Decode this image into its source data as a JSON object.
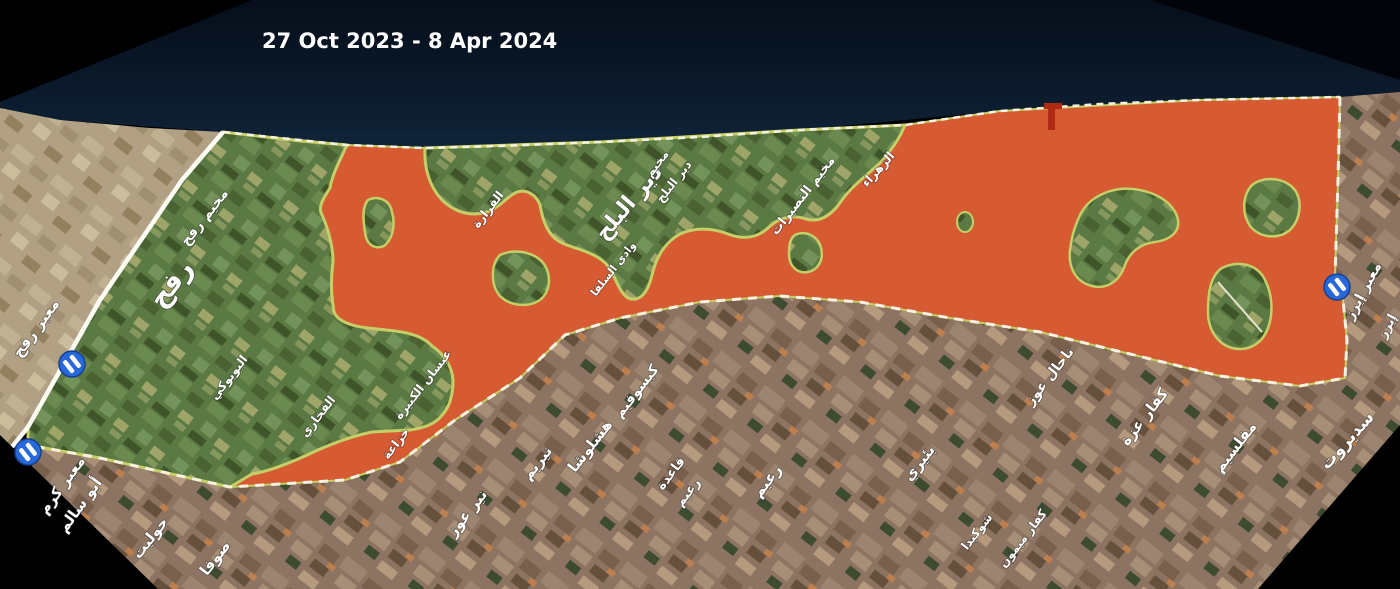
{
  "title": {
    "text": "27 Oct 2023 - 8 Apr 2024"
  },
  "map": {
    "colors": {
      "sea_dark": "#060e1a",
      "sea_light": "#102439",
      "overlay_orange": "#d65a32",
      "overlay_fringe": "#c6ce67",
      "gaza_green": "#5b7943",
      "israel_brown": "#8d7462",
      "egypt_tan": "#b1a083",
      "border_dash": "#f6f2de",
      "crossing_blue": "#2968d8",
      "label_white": "#ffffff",
      "pier_red": "#b02a14"
    },
    "labels": [
      {
        "id": "rafah-crossing",
        "text": "معبر رفح"
      },
      {
        "id": "kerem-shalom-1",
        "text": "معبر كرم"
      },
      {
        "id": "kerem-shalom-2",
        "text": "أبو سالم"
      },
      {
        "id": "rafah-camp",
        "text": "مخيم رفح"
      },
      {
        "id": "rafah-city",
        "text": "رفح"
      },
      {
        "id": "biyuki",
        "text": "البويوكي"
      },
      {
        "id": "fukhari",
        "text": "الفخاري"
      },
      {
        "id": "absan-kabira",
        "text": "عبسان الكبيرة"
      },
      {
        "id": "khuzaa",
        "text": "خزاعة"
      },
      {
        "id": "qarara",
        "text": "القرارة"
      },
      {
        "id": "wadi-salqa",
        "text": "وادي السلقا"
      },
      {
        "id": "deir-al-balah",
        "text": "دير البلح"
      },
      {
        "id": "deir-balah-camp-1",
        "text": "مخيم"
      },
      {
        "id": "deir-balah-camp-2",
        "text": "دير البلح"
      },
      {
        "id": "nuseirat-camp",
        "text": "مخيم النصيرات"
      },
      {
        "id": "zahra",
        "text": "الزهراء"
      },
      {
        "id": "holit",
        "text": "حوليت"
      },
      {
        "id": "sufa",
        "text": "صوفا"
      },
      {
        "id": "nir-oz",
        "text": "نير عوز"
      },
      {
        "id": "nirim",
        "text": "نيريم"
      },
      {
        "id": "hashlosha",
        "text": "هشلوشا"
      },
      {
        "id": "kissufim",
        "text": "كيسوفيم"
      },
      {
        "id": "reim-base-1",
        "text": "قاعدة"
      },
      {
        "id": "reim-base-2",
        "text": "رعيم"
      },
      {
        "id": "reim",
        "text": "رعيم"
      },
      {
        "id": "beeri",
        "text": "بئيري"
      },
      {
        "id": "shokeda",
        "text": "شوكيدا"
      },
      {
        "id": "kfar-maimon",
        "text": "كفار ميمون"
      },
      {
        "id": "nahal-oz",
        "text": "ناحال عوز"
      },
      {
        "id": "kfar-aza",
        "text": "كفار عزة"
      },
      {
        "id": "mefalsim",
        "text": "مفلسيم"
      },
      {
        "id": "erez-crossing",
        "text": "معبر إيرز"
      },
      {
        "id": "erez",
        "text": "إيرز"
      },
      {
        "id": "sderot",
        "text": "سديروت"
      }
    ],
    "crossing_icons": [
      {
        "id": "rafah-crossing-icon",
        "x": 72,
        "y": 364
      },
      {
        "id": "kerem-shalom-crossing-icon",
        "x": 28,
        "y": 452
      },
      {
        "id": "erez-crossing-icon",
        "x": 1337,
        "y": 287
      }
    ]
  }
}
